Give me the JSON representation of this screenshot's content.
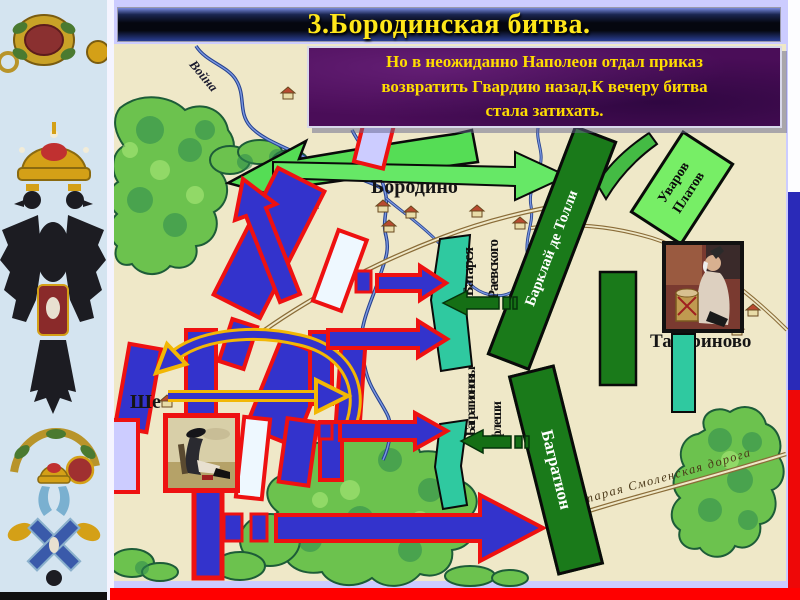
{
  "slide": {
    "title": "3.Бородинская битва.",
    "callout_lines": [
      "Но в неожиданно Наполеон отдал приказ",
      "возвратить Гвардию назад.К вечеру битва",
      "стала затихать."
    ]
  },
  "map_labels": {
    "borodino": "Бородино",
    "tatarinovo": "Татариново",
    "shevardino": "Ше",
    "voina_river": "Война",
    "old_smolensk_road": "Старая Смоленская дорога"
  },
  "units": {
    "barclay": "Барклай де Толли",
    "bagration": "Багратион",
    "uvarov": "Уваров",
    "platov": "Платов",
    "raevsky": [
      "Батарея",
      "Раевского"
    ],
    "fleches": [
      "Багратионовы",
      "флеши"
    ]
  },
  "colors": {
    "slide_bg": "#ccccff",
    "map_bg": "#efe8c8",
    "title_text": "#ffe71a",
    "callout_bg": "#4a0d58",
    "callout_text": "#ffdd00",
    "french_blue": "#3333cc",
    "french_border": "#ee1111",
    "russian_dark_green": "#1a7a1a",
    "russian_light_green": "#55dd55",
    "teal_fortification": "#2fc9a0",
    "gold_arrow_outline": "#f2b705",
    "bottom_bar_red": "#ff0000"
  }
}
